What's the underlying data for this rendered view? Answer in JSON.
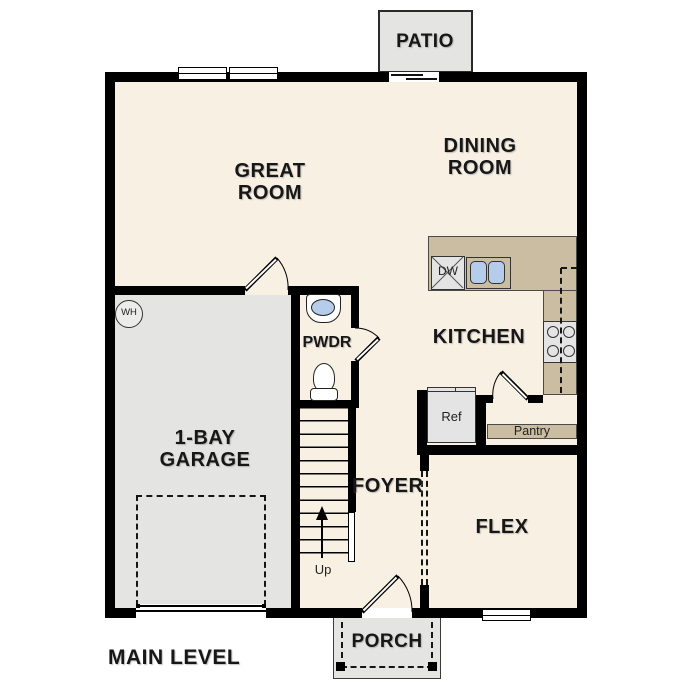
{
  "plan_title": "MAIN LEVEL",
  "colors": {
    "floor": "#f8f0e3",
    "outdoor": "#e4e4e2",
    "counter": "#cabda2",
    "sink": "#b5cdeb",
    "wall": "#000000",
    "appliance": "#e4e4e4"
  },
  "rooms": {
    "patio": "PATIO",
    "great_room": "GREAT ROOM",
    "dining_room": "DINING ROOM",
    "kitchen": "KITCHEN",
    "powder_room": "PWDR",
    "garage": "1-BAY GARAGE",
    "foyer": "FOYER",
    "flex": "FLEX",
    "porch": "PORCH"
  },
  "features": {
    "pantry": "Pantry",
    "refrigerator": "Ref",
    "dishwasher": "DW",
    "water_heater": "WH",
    "stairs_direction": "Up"
  }
}
